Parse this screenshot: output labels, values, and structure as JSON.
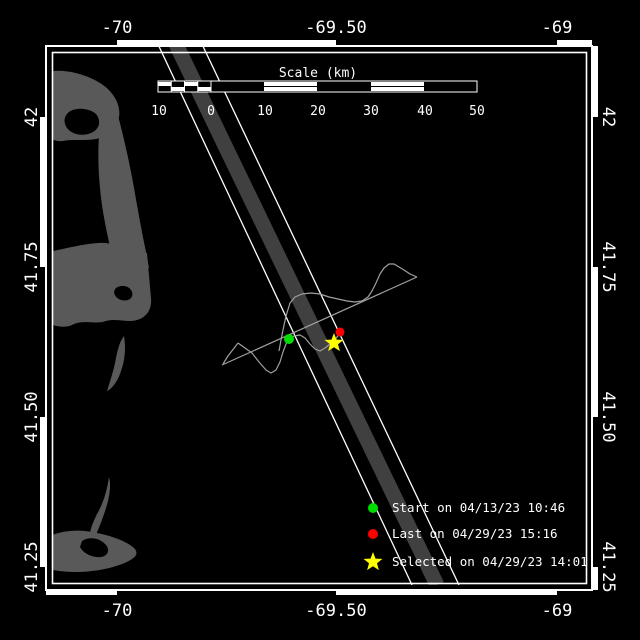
{
  "canvas": {
    "w": 640,
    "h": 640,
    "bg": "#000000"
  },
  "colors": {
    "frame": "#ffffff",
    "text": "#ffffff",
    "land": "#595959",
    "water": "#000000",
    "swath_band": "#404040",
    "swath_edge": "#ffffff",
    "track": "#a0a0a0",
    "start": "#00dd00",
    "last": "#ff0000",
    "selected": "#ffff00"
  },
  "frame": {
    "outer_box": [
      46,
      46,
      592,
      590
    ],
    "inner_box": [
      52.5,
      52.5,
      586.5,
      583.5
    ],
    "zebra_px": 5,
    "lon_ticks": [
      {
        "label": "-70",
        "px": 117
      },
      {
        "label": "-69.50",
        "px": 336
      },
      {
        "label": "-69",
        "px": 557
      }
    ],
    "lat_ticks": [
      {
        "label": "42",
        "px": 117
      },
      {
        "label": "41.75",
        "px": 267
      },
      {
        "label": "41.50",
        "px": 417
      },
      {
        "label": "41.25",
        "px": 567
      }
    ],
    "zebra_start": {
      "top": "b",
      "bottom": "w",
      "left": "b",
      "right": "w"
    },
    "label_offsets": {
      "top_y": 33,
      "bottom_y": 616,
      "left_x": 32,
      "right_x": 608
    }
  },
  "scale_bar": {
    "title": "Scale (km)",
    "title_x": 318,
    "title_y": 77,
    "x0": 158,
    "x1": 477,
    "y0": 81,
    "y1": 92,
    "zero_x": 211,
    "subdiv_cells": 4,
    "white_segments": [
      [
        264,
        317
      ],
      [
        371,
        424
      ]
    ],
    "labels": [
      {
        "t": "10",
        "x": 159
      },
      {
        "t": "0",
        "x": 211
      },
      {
        "t": "10",
        "x": 265
      },
      {
        "t": "20",
        "x": 318
      },
      {
        "t": "30",
        "x": 371
      },
      {
        "t": "40",
        "x": 425
      },
      {
        "t": "50",
        "x": 477
      }
    ],
    "labels_y": 115
  },
  "swath": {
    "y_top": 40,
    "y_bottom": 585,
    "band": {
      "x_top": 174,
      "x_bottom": 437,
      "width": 15
    },
    "edges": [
      {
        "x_top": 156,
        "x_bottom": 412
      },
      {
        "x_top": 200,
        "x_bottom": 459
      }
    ]
  },
  "land": {
    "shapes": [
      {
        "name": "cape-cod-provincetown",
        "fill": "land",
        "d": "M48,72 C62,68 88,74 103,85 C114,93 121,105 119,117 C117,129 108,137 96,139 C84,141 72,139 63,141 C55,142 49,138 48,134 Z"
      },
      {
        "name": "provincetown-harbor",
        "fill": "water",
        "d": "M69,112 C76,107 89,108 96,114 C101,120 100,128 93,132 C84,137 72,135 67,128 C63,122 64,116 69,112 Z"
      },
      {
        "name": "cape-cod-arm",
        "fill": "land",
        "d": "M99,136 L117,112 C123,134 129,160 134,188 C138,211 142,233 146,252 L149,268 L113,260 C108,238 102,212 100,188 C98,168 98,150 99,136 Z"
      },
      {
        "name": "cape-cod-midcape",
        "fill": "land",
        "d": "M48,252 C64,249 82,244 98,243 C110,242 120,246 128,249 L147,253 L151,298 C152,309 147,317 137,320 C127,323 117,318 106,321 C95,325 84,319 72,325 C63,329 54,325 48,324 Z"
      },
      {
        "name": "chatham-pond",
        "fill": "water",
        "d": "M116,288 C122,284 130,286 132,292 C134,298 128,302 121,300 C115,298 112,292 116,288 Z"
      },
      {
        "name": "monomoy-island",
        "fill": "land",
        "d": "M124,336 C126,348 125,360 121,371 C118,381 112,389 107,391 C110,381 114,370 116,358 C118,348 120,341 124,336 Z"
      },
      {
        "name": "nantucket-great-point",
        "fill": "land",
        "d": "M109,477 C107,491 103,504 97,514 C94,520 91,527 90,533 L96,535 C100,525 105,513 108,501 C110,492 111,484 109,477 Z"
      },
      {
        "name": "nantucket-island",
        "fill": "land",
        "d": "M48,537 C62,530 80,529 97,533 C112,536 126,541 134,548 C138,552 137,556 132,559 C123,565 108,569 92,571 C77,573 61,572 48,569 Z"
      },
      {
        "name": "nantucket-harbor",
        "fill": "water",
        "d": "M82,541 C90,536 100,538 106,545 C110,550 108,556 101,557 C92,558 83,553 80,547 Z"
      }
    ]
  },
  "tracks": {
    "lines": [
      {
        "name": "direct-line",
        "points": [
          [
            222,
            365
          ],
          [
            417,
            277
          ]
        ]
      },
      {
        "name": "track-start-loop",
        "points": [
          [
            238,
            343
          ],
          [
            228,
            356
          ],
          [
            223,
            364
          ]
        ]
      },
      {
        "name": "drift-track",
        "points": [
          [
            238,
            343
          ],
          [
            245,
            348
          ],
          [
            252,
            353
          ],
          [
            259,
            362
          ],
          [
            266,
            370
          ],
          [
            271,
            373
          ],
          [
            276,
            370
          ],
          [
            280,
            362
          ],
          [
            283,
            352
          ],
          [
            286,
            344
          ],
          [
            289,
            339
          ],
          [
            294,
            336
          ],
          [
            300,
            335
          ],
          [
            305,
            338
          ],
          [
            310,
            344
          ],
          [
            315,
            349
          ],
          [
            320,
            351
          ],
          [
            325,
            348
          ],
          [
            330,
            344
          ],
          [
            334,
            342
          ],
          [
            337,
            337
          ],
          [
            340,
            333
          ]
        ]
      },
      {
        "name": "drift-track-upper-loop",
        "points": [
          [
            279,
            351
          ],
          [
            281,
            340
          ],
          [
            283,
            330
          ],
          [
            286,
            316
          ],
          [
            290,
            303
          ],
          [
            295,
            297
          ],
          [
            302,
            294
          ],
          [
            311,
            293
          ],
          [
            320,
            294
          ],
          [
            329,
            297
          ],
          [
            338,
            299
          ],
          [
            347,
            301
          ],
          [
            355,
            302
          ],
          [
            362,
            301
          ],
          [
            368,
            297
          ],
          [
            372,
            291
          ],
          [
            376,
            283
          ],
          [
            380,
            274
          ],
          [
            384,
            268
          ],
          [
            389,
            264
          ],
          [
            394,
            264
          ],
          [
            399,
            267
          ],
          [
            404,
            270
          ],
          [
            410,
            274
          ],
          [
            417,
            277
          ]
        ]
      }
    ]
  },
  "markers": {
    "start": {
      "x": 289,
      "y": 339,
      "r": 5
    },
    "last": {
      "x": 340,
      "y": 332,
      "r": 4.5
    },
    "selected": {
      "x": 334,
      "y": 343,
      "r": 10
    }
  },
  "legend": {
    "marker_x": 373,
    "text_x": 392,
    "circle_r": 5,
    "star_r": 10,
    "rows": [
      {
        "y": 508,
        "marker": "circle",
        "color": "start",
        "label": "Start on 04/13/23 10:46"
      },
      {
        "y": 534,
        "marker": "circle",
        "color": "last",
        "label": "Last on 04/29/23 15:16"
      },
      {
        "y": 562,
        "marker": "star",
        "color": "selected",
        "label": "Selected on 04/29/23 14:01"
      }
    ]
  }
}
